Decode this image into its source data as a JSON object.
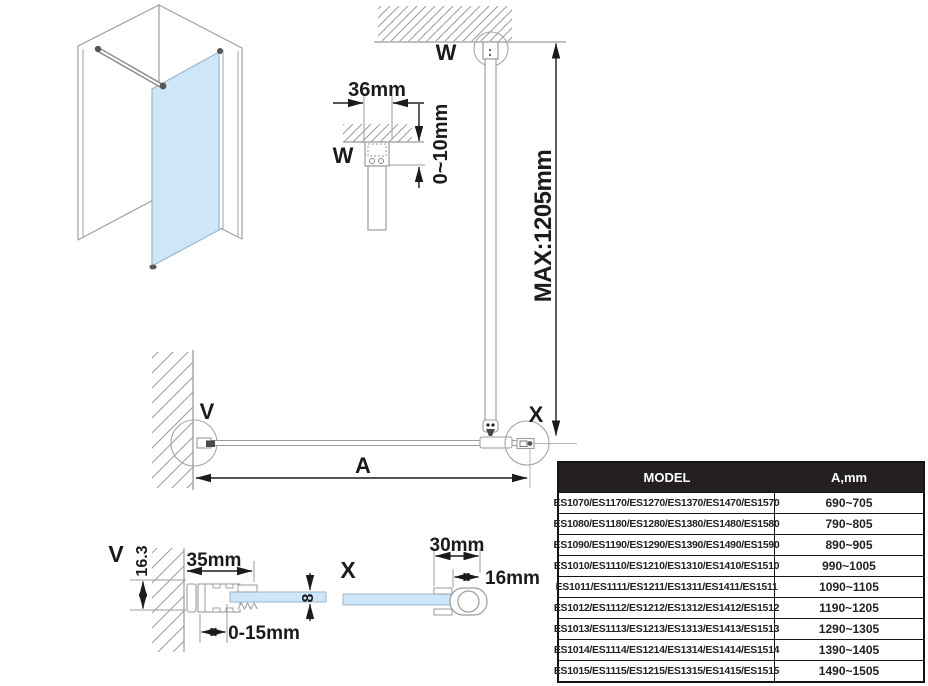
{
  "drawing": {
    "labels": {
      "anchor_w_elevation": "W",
      "anchor_w_detail": "W",
      "anchor_v_plan": "V",
      "anchor_x_plan": "X",
      "anchor_v_detail": "V",
      "anchor_x_detail": "X",
      "width_dim_letter": "A"
    },
    "dimensions": {
      "ceiling_bracket_width": "36mm",
      "ceiling_clearance": "0~10mm",
      "support_bar_max": "MAX:1205mm",
      "wall_profile_height": "16.3",
      "wall_profile_depth": "35mm",
      "adjustment_range": "0-15mm",
      "glass_thickness": "8",
      "end_profile_depth": "30mm",
      "end_profile_tube": "16mm"
    },
    "colors": {
      "glass": "#cde6f8",
      "outline_gray": "#9b9b9b",
      "dimension_black": "#1b1b1b",
      "table_header_bg": "#242020"
    }
  },
  "table": {
    "headers": [
      "MODEL",
      "A,mm"
    ],
    "rows": [
      {
        "model": "ES1070/ES1170/ES1270/ES1370/ES1470/ES1570",
        "a": "690~705"
      },
      {
        "model": "ES1080/ES1180/ES1280/ES1380/ES1480/ES1580",
        "a": "790~805"
      },
      {
        "model": "ES1090/ES1190/ES1290/ES1390/ES1490/ES1590",
        "a": "890~905"
      },
      {
        "model": "ES1010/ES1110/ES1210/ES1310/ES1410/ES1510",
        "a": "990~1005"
      },
      {
        "model": "ES1011/ES1111/ES1211/ES1311/ES1411/ES1511",
        "a": "1090~1105"
      },
      {
        "model": "ES1012/ES1112/ES1212/ES1312/ES1412/ES1512",
        "a": "1190~1205"
      },
      {
        "model": "ES1013/ES1113/ES1213/ES1313/ES1413/ES1513",
        "a": "1290~1305"
      },
      {
        "model": "ES1014/ES1114/ES1214/ES1314/ES1414/ES1514",
        "a": "1390~1405"
      },
      {
        "model": "ES1015/ES1115/ES1215/ES1315/ES1415/ES1515",
        "a": "1490~1505"
      }
    ]
  }
}
